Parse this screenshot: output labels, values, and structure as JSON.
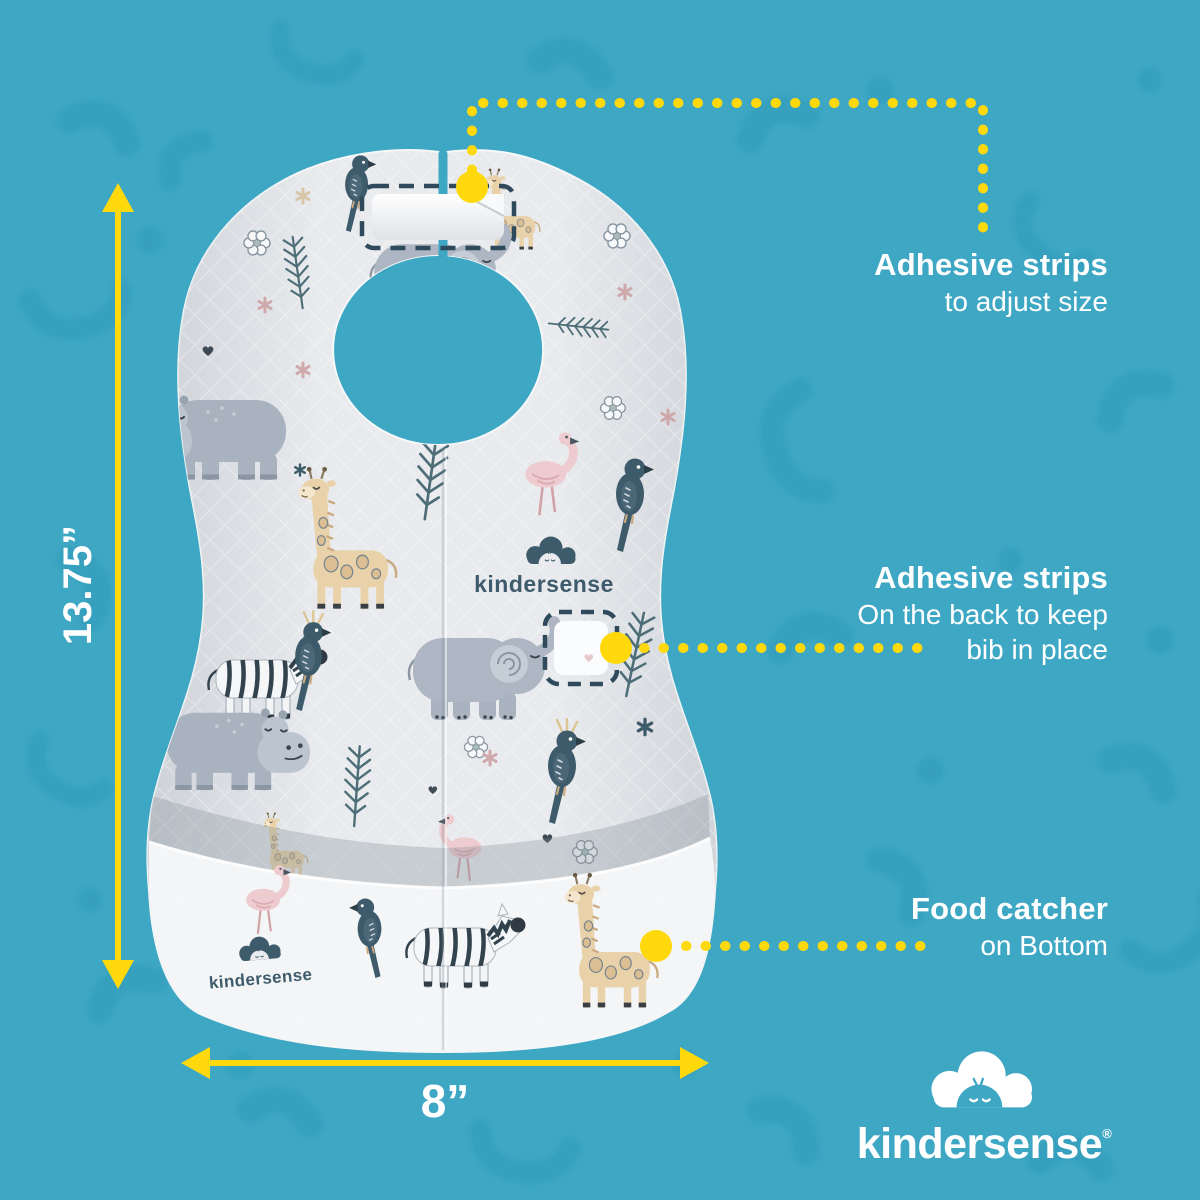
{
  "callouts": {
    "adhesive_top": {
      "title": "Adhesive strips",
      "subtitle": "to adjust size"
    },
    "adhesive_back": {
      "title": "Adhesive strips",
      "line1": "On the back to keep",
      "line2": "bib in place"
    },
    "food_catcher": {
      "title": "Food catcher",
      "subtitle": "on Bottom"
    }
  },
  "dimensions": {
    "height_label": "13.75”",
    "width_label": "8”"
  },
  "brand": {
    "wordmark": "kindersense",
    "registered": "®"
  },
  "bib": {
    "center_logo_text": "kindersense",
    "pocket_logo_text": "kindersense"
  },
  "colors": {
    "background": "#3EA7C4",
    "background_pattern": "#2F9AB8",
    "accent_yellow": "#FFD90B",
    "text_white": "#FFFFFF",
    "bib_base": "#E8EAED",
    "bib_pocket": "#F3F5F7",
    "slate": "#3E5B6B",
    "animal_gray": "#ADB6C2",
    "animal_tan": "#E9D2A9",
    "animal_pink": "#EDCBCE",
    "leaf_green": "#4E6E77"
  }
}
